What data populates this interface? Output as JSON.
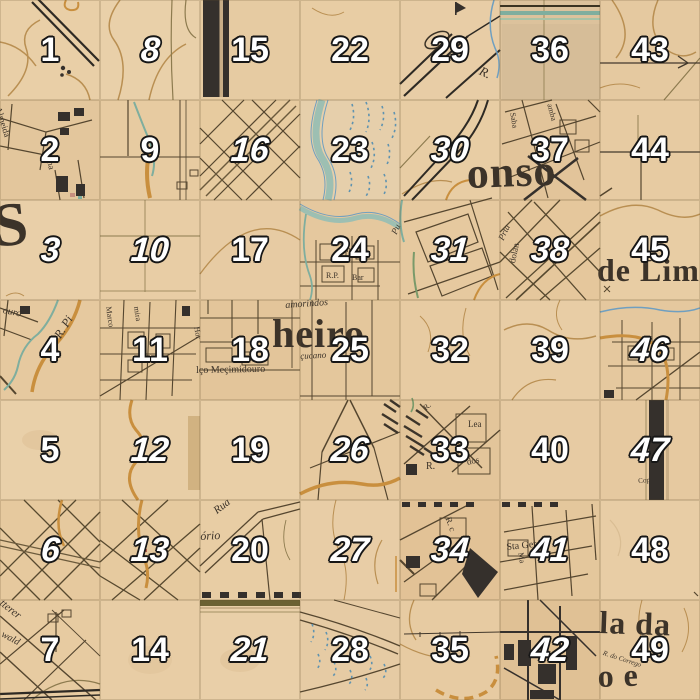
{
  "app": {
    "title": "Numbered map-tile puzzle grid",
    "board_size": "7x7",
    "tile_px": 100
  },
  "grid": {
    "rows": 7,
    "cols": 7,
    "tile_size": 100,
    "tiles": [
      {
        "number": 1,
        "italic": false,
        "shade": "#e9cfa7"
      },
      {
        "number": 8,
        "italic": true,
        "shade": "#e9d0a9"
      },
      {
        "number": 15,
        "italic": false,
        "shade": "#e6cba2"
      },
      {
        "number": 22,
        "italic": false,
        "shade": "#e8cda4"
      },
      {
        "number": 29,
        "italic": false,
        "shade": "#e8cda6"
      },
      {
        "number": 36,
        "italic": false,
        "shade": "#dcc29c"
      },
      {
        "number": 43,
        "italic": false,
        "shade": "#e5c9a0"
      },
      {
        "number": 2,
        "italic": false,
        "shade": "#e3c69c"
      },
      {
        "number": 9,
        "italic": false,
        "shade": "#e7cba1"
      },
      {
        "number": 16,
        "italic": true,
        "shade": "#e7cb9f"
      },
      {
        "number": 23,
        "italic": false,
        "shade": "#e6cfab"
      },
      {
        "number": 30,
        "italic": true,
        "shade": "#e8cda4"
      },
      {
        "number": 37,
        "italic": false,
        "shade": "#e2c49a"
      },
      {
        "number": 44,
        "italic": false,
        "shade": "#e7cba2"
      },
      {
        "number": 3,
        "italic": true,
        "shade": "#e9cfa8"
      },
      {
        "number": 10,
        "italic": true,
        "shade": "#e8cda5"
      },
      {
        "number": 17,
        "italic": false,
        "shade": "#e7cba3"
      },
      {
        "number": 24,
        "italic": false,
        "shade": "#e5c89e"
      },
      {
        "number": 31,
        "italic": true,
        "shade": "#e6c99f"
      },
      {
        "number": 38,
        "italic": true,
        "shade": "#e5c79c"
      },
      {
        "number": 45,
        "italic": false,
        "shade": "#e8cda4"
      },
      {
        "number": 4,
        "italic": false,
        "shade": "#e6c99f"
      },
      {
        "number": 11,
        "italic": false,
        "shade": "#e5c89c"
      },
      {
        "number": 18,
        "italic": false,
        "shade": "#e3c59a"
      },
      {
        "number": 25,
        "italic": false,
        "shade": "#e4c79c"
      },
      {
        "number": 32,
        "italic": false,
        "shade": "#e7cba2"
      },
      {
        "number": 39,
        "italic": false,
        "shade": "#e8cda5"
      },
      {
        "number": 46,
        "italic": true,
        "shade": "#e5c89e"
      },
      {
        "number": 5,
        "italic": false,
        "shade": "#e9d0a9"
      },
      {
        "number": 12,
        "italic": true,
        "shade": "#e8cea6"
      },
      {
        "number": 19,
        "italic": false,
        "shade": "#e9cfa7"
      },
      {
        "number": 26,
        "italic": true,
        "shade": "#e6c99f"
      },
      {
        "number": 33,
        "italic": false,
        "shade": "#e3c59a"
      },
      {
        "number": 40,
        "italic": false,
        "shade": "#e7cba3"
      },
      {
        "number": 47,
        "italic": true,
        "shade": "#e6c9a0"
      },
      {
        "number": 6,
        "italic": true,
        "shade": "#e6c99e"
      },
      {
        "number": 13,
        "italic": true,
        "shade": "#e6ca9f"
      },
      {
        "number": 20,
        "italic": false,
        "shade": "#e8cda4"
      },
      {
        "number": 27,
        "italic": true,
        "shade": "#e8cda6"
      },
      {
        "number": 34,
        "italic": true,
        "shade": "#e2c296"
      },
      {
        "number": 41,
        "italic": true,
        "shade": "#e4c79c"
      },
      {
        "number": 48,
        "italic": false,
        "shade": "#e8cda5"
      },
      {
        "number": 7,
        "italic": false,
        "shade": "#e7cba1"
      },
      {
        "number": 14,
        "italic": false,
        "shade": "#e8cda5"
      },
      {
        "number": 21,
        "italic": true,
        "shade": "#e9cfa8"
      },
      {
        "number": 28,
        "italic": false,
        "shade": "#e6cba4"
      },
      {
        "number": 35,
        "italic": false,
        "shade": "#e7cba2"
      },
      {
        "number": 42,
        "italic": true,
        "shade": "#e0c195"
      },
      {
        "number": 49,
        "italic": false,
        "shade": "#e5c89e"
      }
    ]
  },
  "number_style": {
    "fill": "#ffffff",
    "outline": "#161616"
  },
  "map_labels": {
    "large": [
      {
        "id": "big-s",
        "text": "S",
        "x": -10,
        "y": 196,
        "size": 62,
        "rot": -6
      },
      {
        "id": "onso",
        "text": "onso",
        "x": 466,
        "y": 152,
        "size": 44,
        "rot": -2
      },
      {
        "id": "heiro",
        "text": "heiro",
        "x": 272,
        "y": 314,
        "size": 40,
        "rot": 0
      },
      {
        "id": "de-lim",
        "text": "de Lim",
        "x": 597,
        "y": 254,
        "size": 32,
        "rot": 0
      },
      {
        "id": "la-da",
        "text": "la  da",
        "x": 600,
        "y": 606,
        "size": 32,
        "rot": 2
      },
      {
        "id": "o-e",
        "text": "o   e",
        "x": 597,
        "y": 660,
        "size": 32,
        "rot": -2
      }
    ],
    "small": [
      {
        "id": "almeida",
        "text": "Almeida",
        "x": 2,
        "y": 106,
        "size": 9,
        "rot": 72,
        "italic": false
      },
      {
        "id": "lima",
        "text": "Lima",
        "x": 52,
        "y": 150,
        "size": 9,
        "rot": 78,
        "italic": false
      },
      {
        "id": "r-29",
        "text": "R.",
        "x": 483,
        "y": 64,
        "size": 13,
        "rot": 25,
        "italic": true
      },
      {
        "id": "saba",
        "text": "Saba",
        "x": 516,
        "y": 112,
        "size": 8,
        "rot": 80,
        "italic": false
      },
      {
        "id": "amba",
        "text": "amba",
        "x": 553,
        "y": 103,
        "size": 8,
        "rot": 75,
        "italic": false
      },
      {
        "id": "ouro",
        "text": "ouro",
        "x": 4,
        "y": 306,
        "size": 10,
        "rot": 12,
        "italic": true
      },
      {
        "id": "r-pi",
        "text": "R. Pi",
        "x": 52,
        "y": 334,
        "size": 12,
        "rot": -58,
        "italic": true
      },
      {
        "id": "marco",
        "text": "Marco",
        "x": 112,
        "y": 306,
        "size": 8,
        "rot": 82,
        "italic": false
      },
      {
        "id": "mira",
        "text": "mira",
        "x": 140,
        "y": 306,
        "size": 8,
        "rot": 82,
        "italic": false
      },
      {
        "id": "hor",
        "text": "Hor",
        "x": 200,
        "y": 326,
        "size": 8,
        "rot": 80,
        "italic": false
      },
      {
        "id": "sn",
        "text": "Sn",
        "x": 342,
        "y": 246,
        "size": 8,
        "rot": 0,
        "italic": false
      },
      {
        "id": "rp",
        "text": "R.P.",
        "x": 326,
        "y": 272,
        "size": 8,
        "rot": 0,
        "italic": false
      },
      {
        "id": "bar",
        "text": "Bar",
        "x": 352,
        "y": 274,
        "size": 8,
        "rot": 0,
        "italic": false
      },
      {
        "id": "pu",
        "text": "Pu",
        "x": 390,
        "y": 232,
        "size": 9,
        "rot": -65,
        "italic": true
      },
      {
        "id": "prta",
        "text": "Prta",
        "x": 497,
        "y": 238,
        "size": 9,
        "rot": -65,
        "italic": true
      },
      {
        "id": "dolan",
        "text": "dolan",
        "x": 508,
        "y": 262,
        "size": 9,
        "rot": -78,
        "italic": false
      },
      {
        "id": "amorindos",
        "text": "amorindos",
        "x": 285,
        "y": 301,
        "size": 10,
        "rot": -4,
        "italic": true
      },
      {
        "id": "cucano",
        "text": "çucano",
        "x": 300,
        "y": 352,
        "size": 9,
        "rot": -3,
        "italic": true
      },
      {
        "id": "mecimidouro",
        "text": "lço Meçimidouro",
        "x": 196,
        "y": 366,
        "size": 10,
        "rot": -1,
        "italic": false
      },
      {
        "id": "lea",
        "text": "Lea",
        "x": 468,
        "y": 420,
        "size": 9,
        "rot": 0,
        "italic": false
      },
      {
        "id": "dos",
        "text": "dos",
        "x": 466,
        "y": 458,
        "size": 9,
        "rot": -12,
        "italic": false
      },
      {
        "id": "r-33",
        "text": "R.",
        "x": 426,
        "y": 462,
        "size": 10,
        "rot": 0,
        "italic": false
      },
      {
        "id": "r-33b",
        "text": "R.",
        "x": 422,
        "y": 406,
        "size": 8,
        "rot": -40,
        "italic": false
      },
      {
        "id": "sta-ger",
        "text": "Sta Ger Tr",
        "x": 506,
        "y": 543,
        "size": 10,
        "rot": -6,
        "italic": false
      },
      {
        "id": "ma-41",
        "text": "Ma",
        "x": 524,
        "y": 552,
        "size": 8,
        "rot": 80,
        "italic": false
      },
      {
        "id": "r-34",
        "text": "R. c",
        "x": 452,
        "y": 516,
        "size": 9,
        "rot": 70,
        "italic": false
      },
      {
        "id": "rua",
        "text": "Rua",
        "x": 212,
        "y": 508,
        "size": 11,
        "rot": -38,
        "italic": true
      },
      {
        "id": "orio",
        "text": "ório",
        "x": 200,
        "y": 530,
        "size": 12,
        "rot": -3,
        "italic": true
      },
      {
        "id": "cop",
        "text": "Cop",
        "x": 638,
        "y": 478,
        "size": 7,
        "rot": -5,
        "italic": false
      },
      {
        "id": "tterer",
        "text": "tterer",
        "x": 4,
        "y": 598,
        "size": 11,
        "rot": 38,
        "italic": true
      },
      {
        "id": "wald",
        "text": "wald",
        "x": 4,
        "y": 630,
        "size": 10,
        "rot": 28,
        "italic": true
      },
      {
        "id": "corrego",
        "text": "R. do Corrego",
        "x": 604,
        "y": 650,
        "size": 7,
        "rot": 18,
        "italic": true
      }
    ]
  },
  "colors": {
    "parchment": "#e8cda6",
    "contour_tan": "#b98f52",
    "olive": "#8d7b4f",
    "street_dark": "#55462f",
    "rail_charcoal": "#2e2a24",
    "teal_river": "#7fae9e",
    "river_fill": "#9dbfb2",
    "marsh_blue": "#5f93b0",
    "stream_blue": "#6f9fc0",
    "road_orange": "#c98f3e",
    "bar_black": "#332e2a",
    "bar_gap": "#c9ae87",
    "text_dark": "#3c3329"
  }
}
